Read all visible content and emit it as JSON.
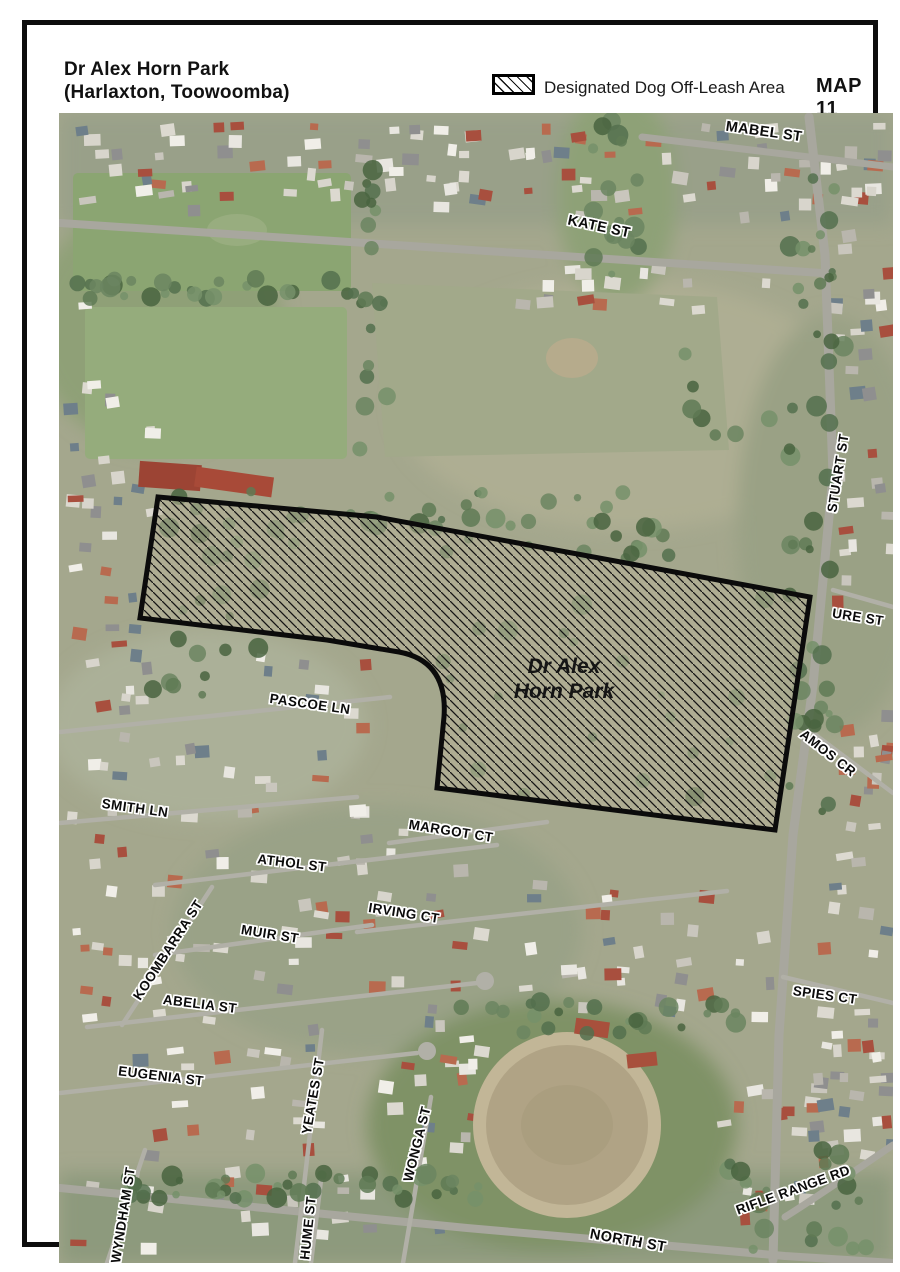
{
  "page": {
    "title_line1": "Dr Alex Horn Park",
    "title_line2": "(Harlaxton, Toowoomba)",
    "map_number": "MAP 11"
  },
  "legend": {
    "swatch_icon": "diagonal-hatch-swatch",
    "label": "Designated Dog Off-Leash Area"
  },
  "park": {
    "label_line1": "Dr Alex",
    "label_line2": "Horn Park"
  },
  "streets": [
    {
      "text": "MABEL ST"
    },
    {
      "text": "KATE ST"
    },
    {
      "text": "STUART ST"
    },
    {
      "text": "URE ST"
    },
    {
      "text": "AMOS CR"
    },
    {
      "text": "PASCOE LN"
    },
    {
      "text": "SMITH LN"
    },
    {
      "text": "MARGOT CT"
    },
    {
      "text": "ATHOL ST"
    },
    {
      "text": "IRVING CT"
    },
    {
      "text": "MUIR ST"
    },
    {
      "text": "KOOMBARRA ST"
    },
    {
      "text": "ABELIA ST"
    },
    {
      "text": "EUGENIA ST"
    },
    {
      "text": "SPIES CT"
    },
    {
      "text": "YEATES ST"
    },
    {
      "text": "WONGA ST"
    },
    {
      "text": "WYNDHAM ST"
    },
    {
      "text": "HUME ST"
    },
    {
      "text": "NORTH ST"
    },
    {
      "text": "RIFLE RANGE RD"
    }
  ],
  "colors": {
    "outline": "#0d0d0d",
    "hatch_line": "#141414",
    "aerial_base": "#a4a78d"
  }
}
